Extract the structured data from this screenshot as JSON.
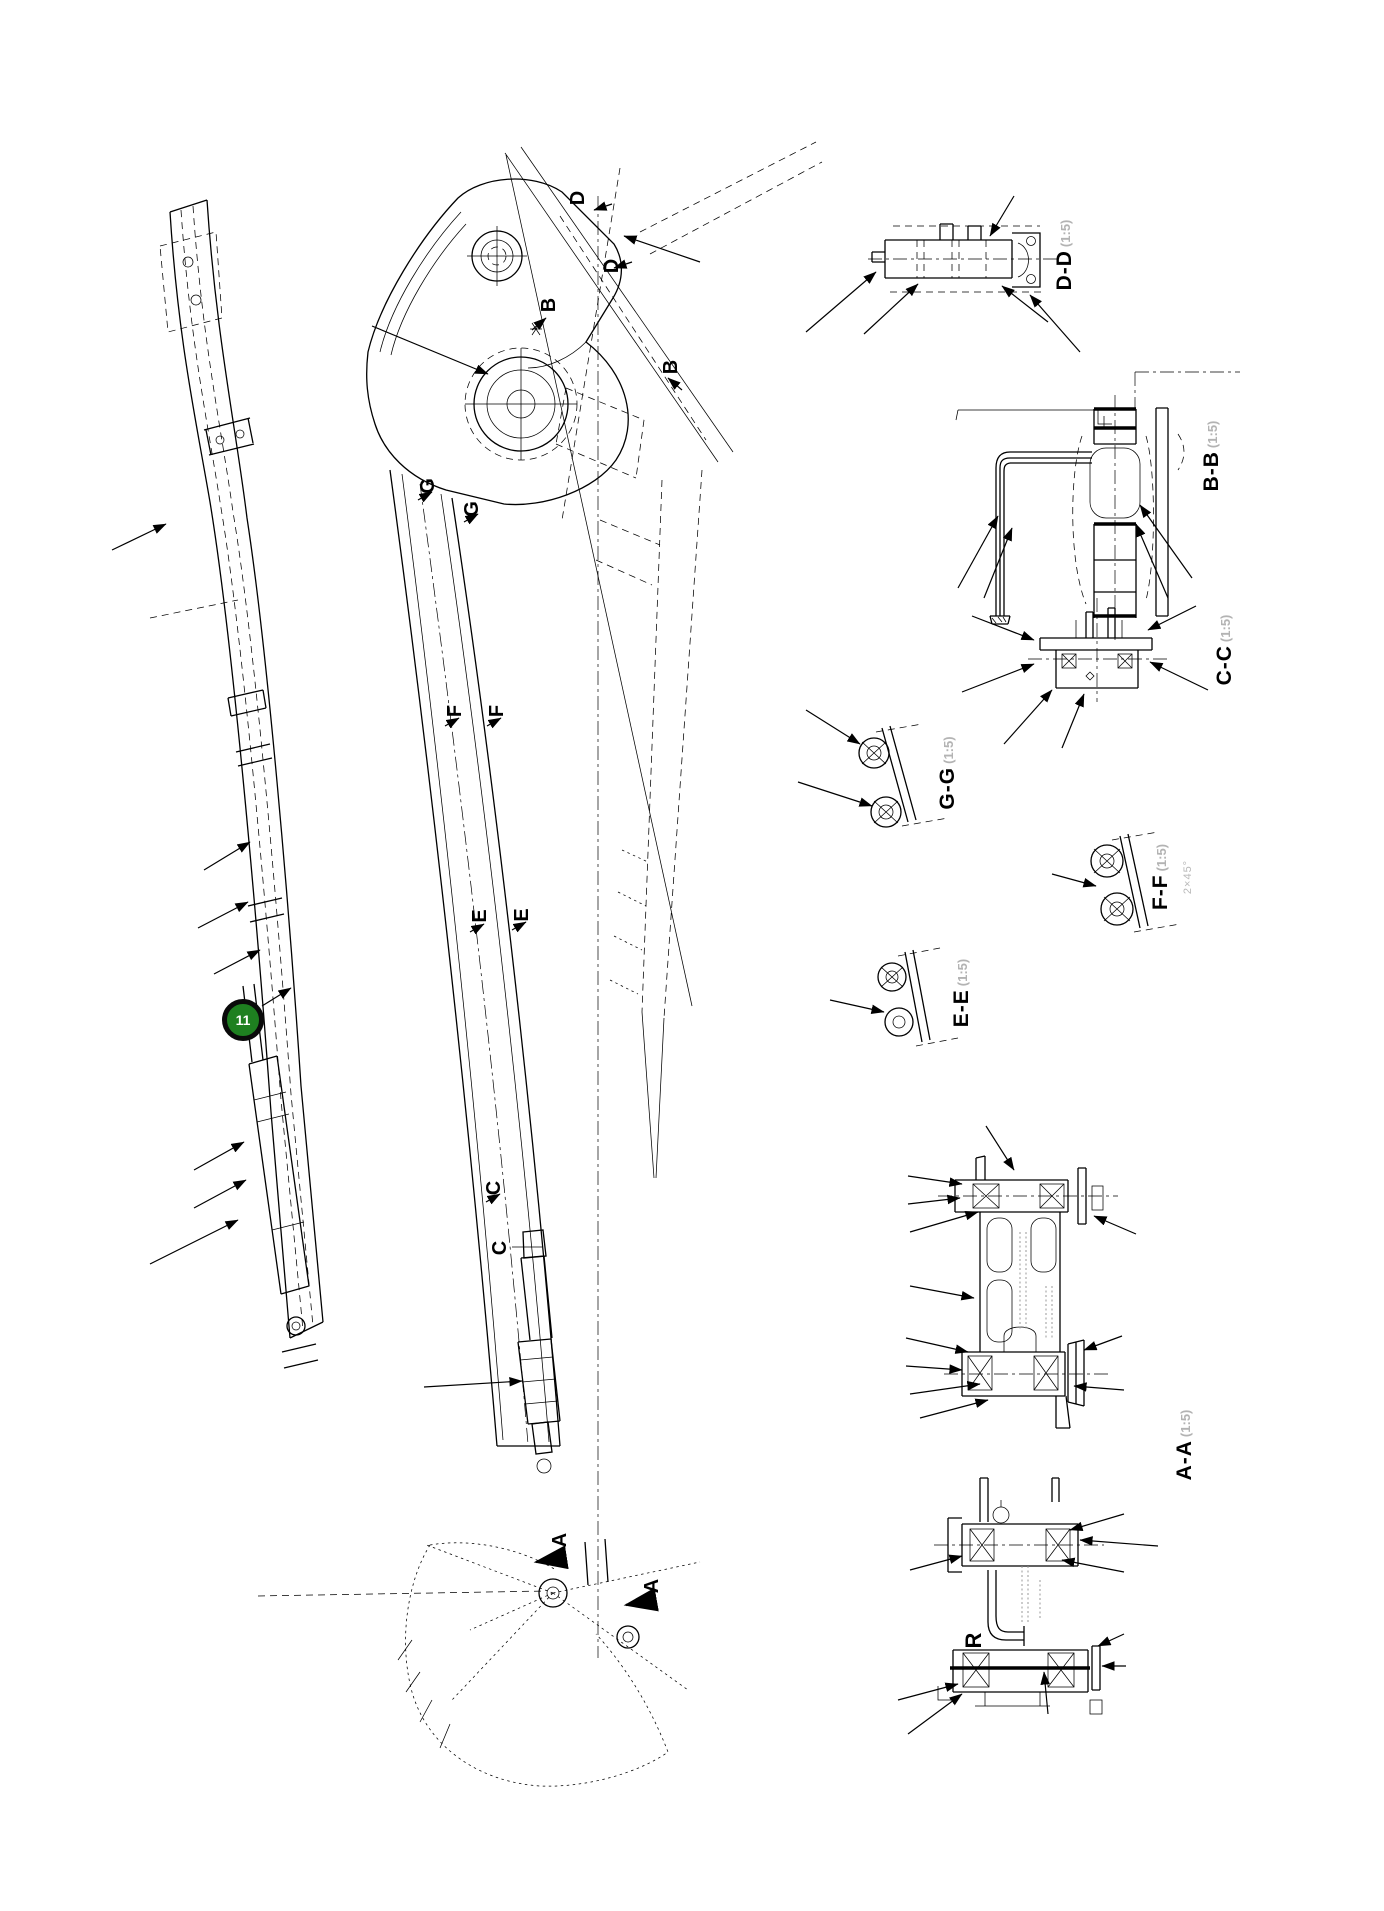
{
  "callout": {
    "number": "11"
  },
  "sections": {
    "dd": {
      "label": "D-D",
      "scale": "(1:5)"
    },
    "bb": {
      "label": "B-B",
      "scale": "(1:5)"
    },
    "cc": {
      "label": "C-C",
      "scale": "(1:5)"
    },
    "gg": {
      "label": "G-G",
      "scale": "(1:5)"
    },
    "ff": {
      "label": "F-F",
      "scale": "(1:5)"
    },
    "ee": {
      "label": "E-E",
      "scale": "(1:5)"
    },
    "aa": {
      "label": "A-A",
      "scale": "(1:5)"
    },
    "r": {
      "label": "R",
      "scale": ""
    }
  },
  "cut_letters": {
    "d1": "D",
    "d2": "D",
    "b1": "B",
    "b2": "B",
    "g1": "G",
    "g2": "G",
    "f1": "F",
    "f2": "F",
    "e1": "E",
    "e2": "E",
    "c1": "C",
    "c2": "C",
    "a1": "A",
    "a2": "A"
  },
  "notes": {
    "ff_note": "2×45°"
  },
  "colors": {
    "line": "#000000",
    "background": "#ffffff",
    "badge_fill": "#1e8020",
    "badge_text": "#ffffff",
    "scale_text": "#b3b3b3"
  }
}
